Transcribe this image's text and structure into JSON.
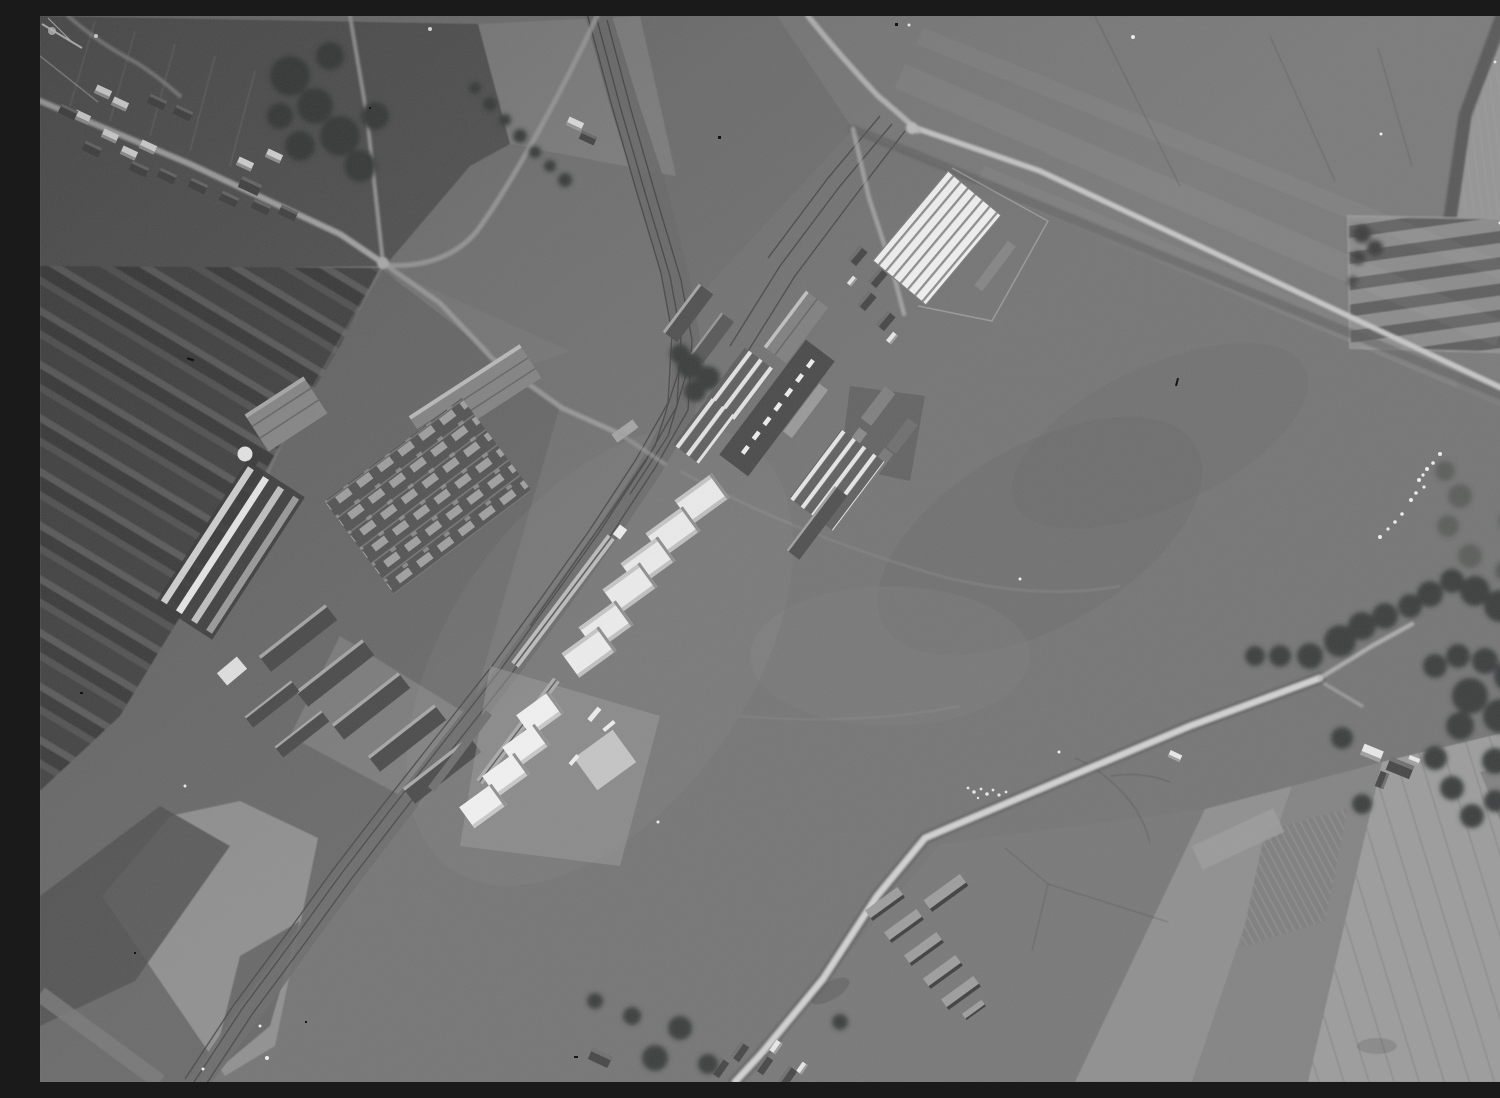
{
  "photo": {
    "medium": "black-and-white vertical aerial reconnaissance photograph, monochrome film with grain, dust specks and emulsion scratches",
    "caption": "Monochrome vertical aerial photograph of a grass airfield with a row of white hangars and sheds along a railway, a large white ribbed-roof hangar, a factory and greenhouse complex, a village along a road, a barracks group, and surrounding farm fields and lanes",
    "palette": {
      "ground_base": "#747474",
      "meadow": "#7a7a7a",
      "field_light": "#9c9c9c",
      "dark_plots": "#464646",
      "shed_white": "#ececec",
      "hangar_light": "#f3f3f3",
      "hangar_rib": "#8f8f8f",
      "roof_dark": "#4a4a4a",
      "skylight": "#a4a4a4",
      "road_bright": "#d2d2d2",
      "road_mid": "#aeaeae",
      "rail_dark": "#454545",
      "tree": "#3a3e3c",
      "greenhouse_stripe": "#e6e6e6"
    },
    "features": {
      "big_ribbed_hangar": {
        "label": "large white hangar with ribbed roof",
        "ribs": 7
      },
      "white_shed_row": {
        "label": "diagonal row of white sheds along railway sidings",
        "count": 10
      },
      "long_workshop": {
        "label": "long dark-roofed workshop with white roof dashes",
        "dashes": 7
      },
      "factory_hall": {
        "label": "factory hall with grid of roof skylights",
        "skylight_rows": 6
      },
      "greenhouse_ranges": {
        "label": "bright striped greenhouse ranges",
        "groups": 4
      },
      "railway": {
        "label": "railway line with sidings",
        "tracks": 3
      },
      "village": {
        "label": "village houses along road, upper left",
        "houses": 19
      },
      "barracks_group": {
        "label": "barracks cluster, lower centre",
        "count": 7
      },
      "farmsteads": {
        "label": "farmsteads with trees",
        "count": 3
      },
      "nursery_plot": {
        "label": "striped nursery plot, upper right",
        "strips": 5
      },
      "airfield": {
        "label": "open grass landing ground, centre and right"
      },
      "field_strips": {
        "label": "dark cultivated strips, left side"
      },
      "white_object_line": {
        "label": "line of small white objects on grass",
        "count": 12
      },
      "film_artifacts": {
        "black_specks": 9,
        "white_dust": 13,
        "scratch_marks": 3
      }
    }
  }
}
